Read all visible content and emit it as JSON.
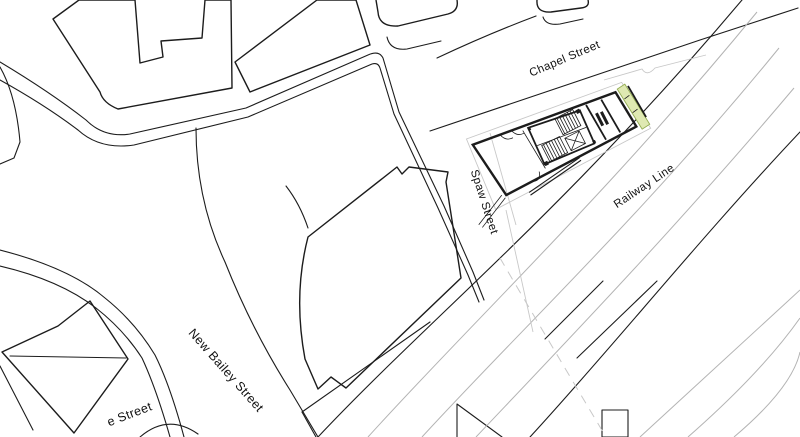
{
  "map": {
    "labels": {
      "chapel_street": "Chapel Street",
      "spaw_street": "Spaw Street",
      "railway_line": "Railway Line",
      "new_bailey_street": "New Bailey Street",
      "partial_street": "e Street"
    },
    "colors": {
      "background": "#ffffff",
      "line_ink": "#1c1c1c",
      "track_gray": "#b3b3b3",
      "boundary_gray": "#c8c8c8",
      "site_highlight_fill": "#dfe9b2",
      "site_highlight_stroke": "#94ad52"
    }
  }
}
